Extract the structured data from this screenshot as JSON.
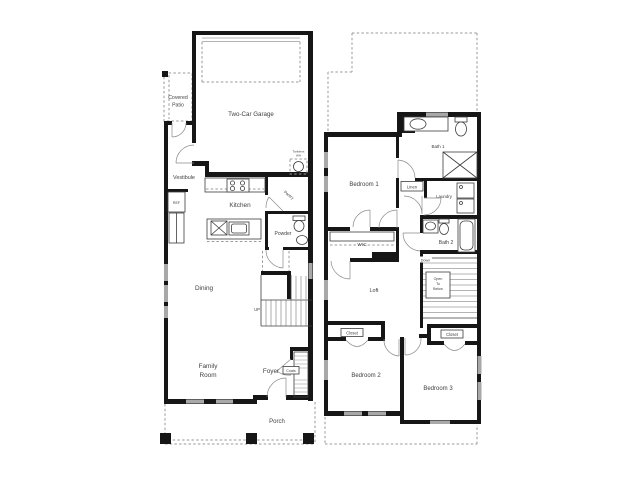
{
  "title": "Two-story floor plan",
  "colors": {
    "wall": "#161616",
    "window_marker": "#a8a8a8",
    "dashed_line": "#9a9a9a",
    "text": "#3f3f3f",
    "background": "#ffffff"
  },
  "first_floor": {
    "garage": "Two-Car Garage",
    "covered_patio_line1": "Covered",
    "covered_patio_line2": "Patio",
    "vestibule": "Vestibule",
    "ref": "REF",
    "kitchen": "Kitchen",
    "pantry": "Pantry",
    "powder": "Powder",
    "tankless_line1": "Tankless",
    "tankless_line2": "WH",
    "dining": "Dining",
    "up": "UP",
    "family_line1": "Family",
    "family_line2": "Room",
    "foyer": "Foyer",
    "coats": "Coats",
    "porch": "Porch"
  },
  "second_floor": {
    "bedroom1": "Bedroom 1",
    "bath1": "Bath 1",
    "linen": "Linen",
    "laundry": "Laundry",
    "wic": "WIC",
    "bath2": "Bath 2",
    "down": "Down",
    "loft": "Loft",
    "open_line1": "Open",
    "open_line2": "To",
    "open_line3": "Below",
    "closet_bedroom2": "Closet",
    "closet_bedroom3": "Closet",
    "bedroom2": "Bedroom 2",
    "bedroom3": "Bedroom 3"
  }
}
